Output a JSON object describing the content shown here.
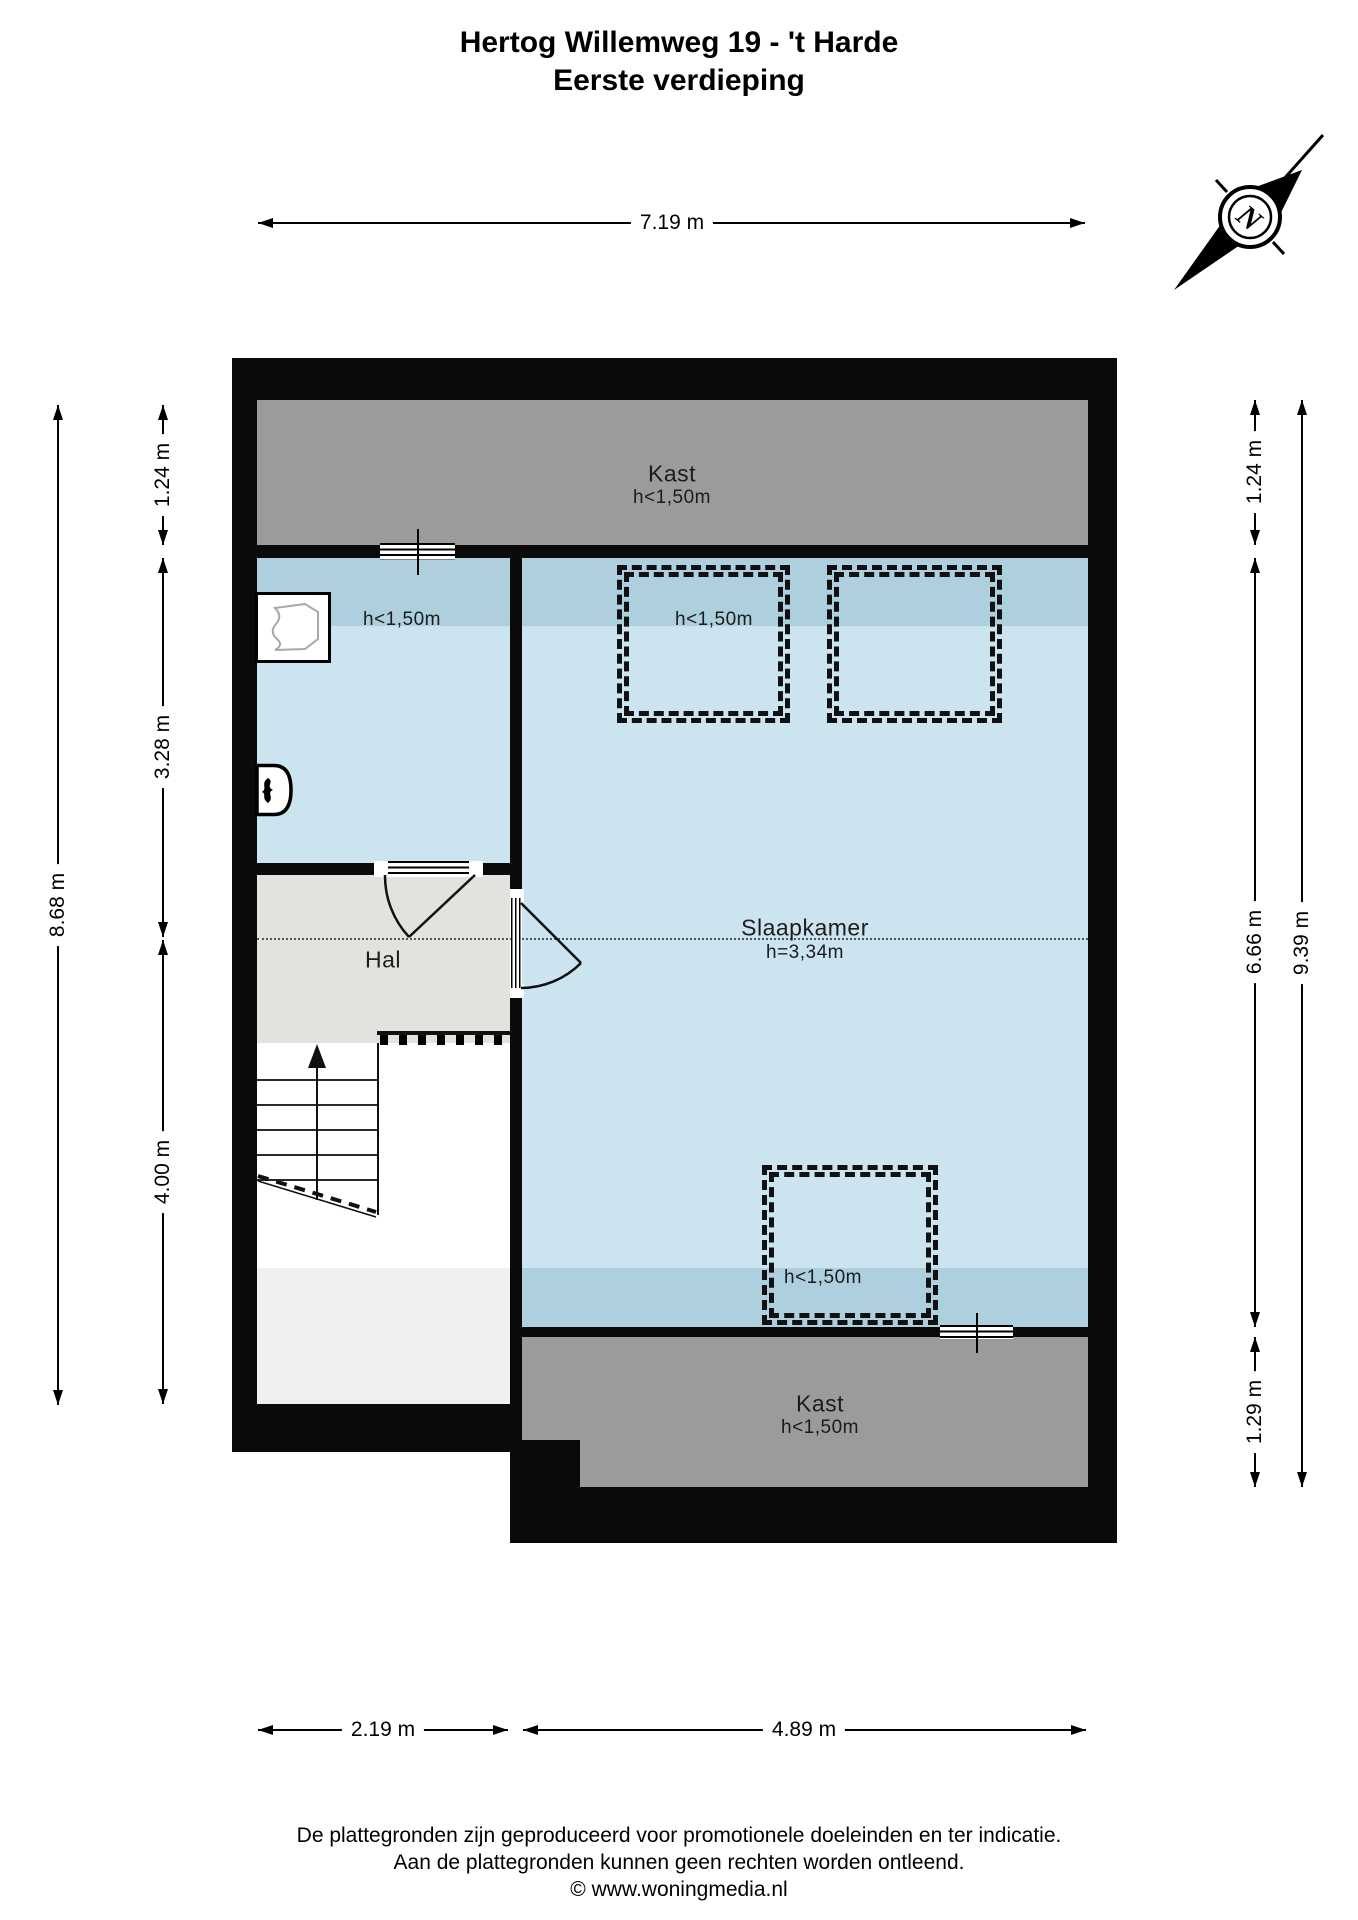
{
  "title": {
    "line1": "Hertog Willemweg 19 - 't Harde",
    "line2": "Eerste verdieping"
  },
  "compass": {
    "north_label": "N"
  },
  "floorplan": {
    "kast_top": {
      "name": "Kast",
      "height": "h<1,50m"
    },
    "left_room": {
      "height": "h<1,50m"
    },
    "slaapkamer": {
      "name": "Slaapkamer",
      "height": "h=3,34m"
    },
    "hal": {
      "name": "Hal"
    },
    "roof_window_top": {
      "height": "h<1,50m"
    },
    "roof_window_bottom": {
      "height": "h<1,50m"
    },
    "kast_bottom": {
      "name": "Kast",
      "height": "h<1,50m"
    }
  },
  "dimensions": {
    "top_width": "7.19 m",
    "left_total": "8.68 m",
    "left_segments": [
      "1.24 m",
      "3.28 m",
      "4.00 m"
    ],
    "right_segments": [
      "1.24 m",
      "6.66 m",
      "1.29 m"
    ],
    "right_total": "9.39 m",
    "bottom_segments": [
      "2.19 m",
      "4.89 m"
    ]
  },
  "footer": {
    "line1": "De plattegronden zijn geproduceerd voor promotionele doeleinden en ter indicatie.",
    "line2": "Aan de plattegronden kunnen geen rechten worden ontleend.",
    "line3": "© www.woningmedia.nl"
  },
  "colors": {
    "wall": "#0a0a0a",
    "room_blue": "#cbe4f0",
    "room_blue_low_ceiling": "#aecfdd",
    "kast_gray": "#9b9b9b",
    "hal_gray": "#e3e2de",
    "void_gray": "#f0f0f0"
  }
}
